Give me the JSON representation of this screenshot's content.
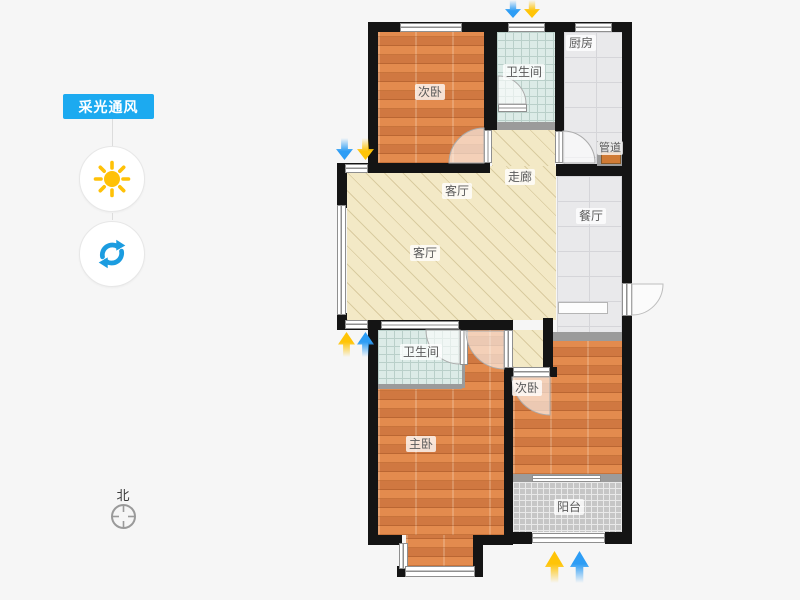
{
  "toolbar": {
    "mode_label": "采光通风",
    "mode_badge_color": "#1caaf0",
    "sun_icon_color": "#ffc107",
    "rotate_icon_color": "#1b9ce0"
  },
  "compass": {
    "north_label": "北"
  },
  "floorplan": {
    "rooms": [
      {
        "id": "bedroom-top",
        "label": "次卧"
      },
      {
        "id": "bathroom-top",
        "label": "卫生间"
      },
      {
        "id": "kitchen",
        "label": "厨房"
      },
      {
        "id": "duct",
        "label": "管道"
      },
      {
        "id": "hallway",
        "label": "走廊"
      },
      {
        "id": "living-upper",
        "label": "客厅"
      },
      {
        "id": "living",
        "label": "客厅"
      },
      {
        "id": "dining",
        "label": "餐厅"
      },
      {
        "id": "bathroom-lower",
        "label": "卫生间"
      },
      {
        "id": "master-bedroom",
        "label": "主卧"
      },
      {
        "id": "bedroom-bottom",
        "label": "次卧"
      },
      {
        "id": "balcony",
        "label": "阳台"
      }
    ],
    "colors": {
      "wall": "#141414",
      "wood_floor": "#dd8045",
      "living_floor": "#f3e9c6",
      "bath_tile": "#dcebe7",
      "gray_tile": "#e9e9eb",
      "balcony_tile": "#c6c6c6",
      "arrow_blue": "#2d9df5",
      "arrow_yellow": "#ffc407"
    }
  }
}
